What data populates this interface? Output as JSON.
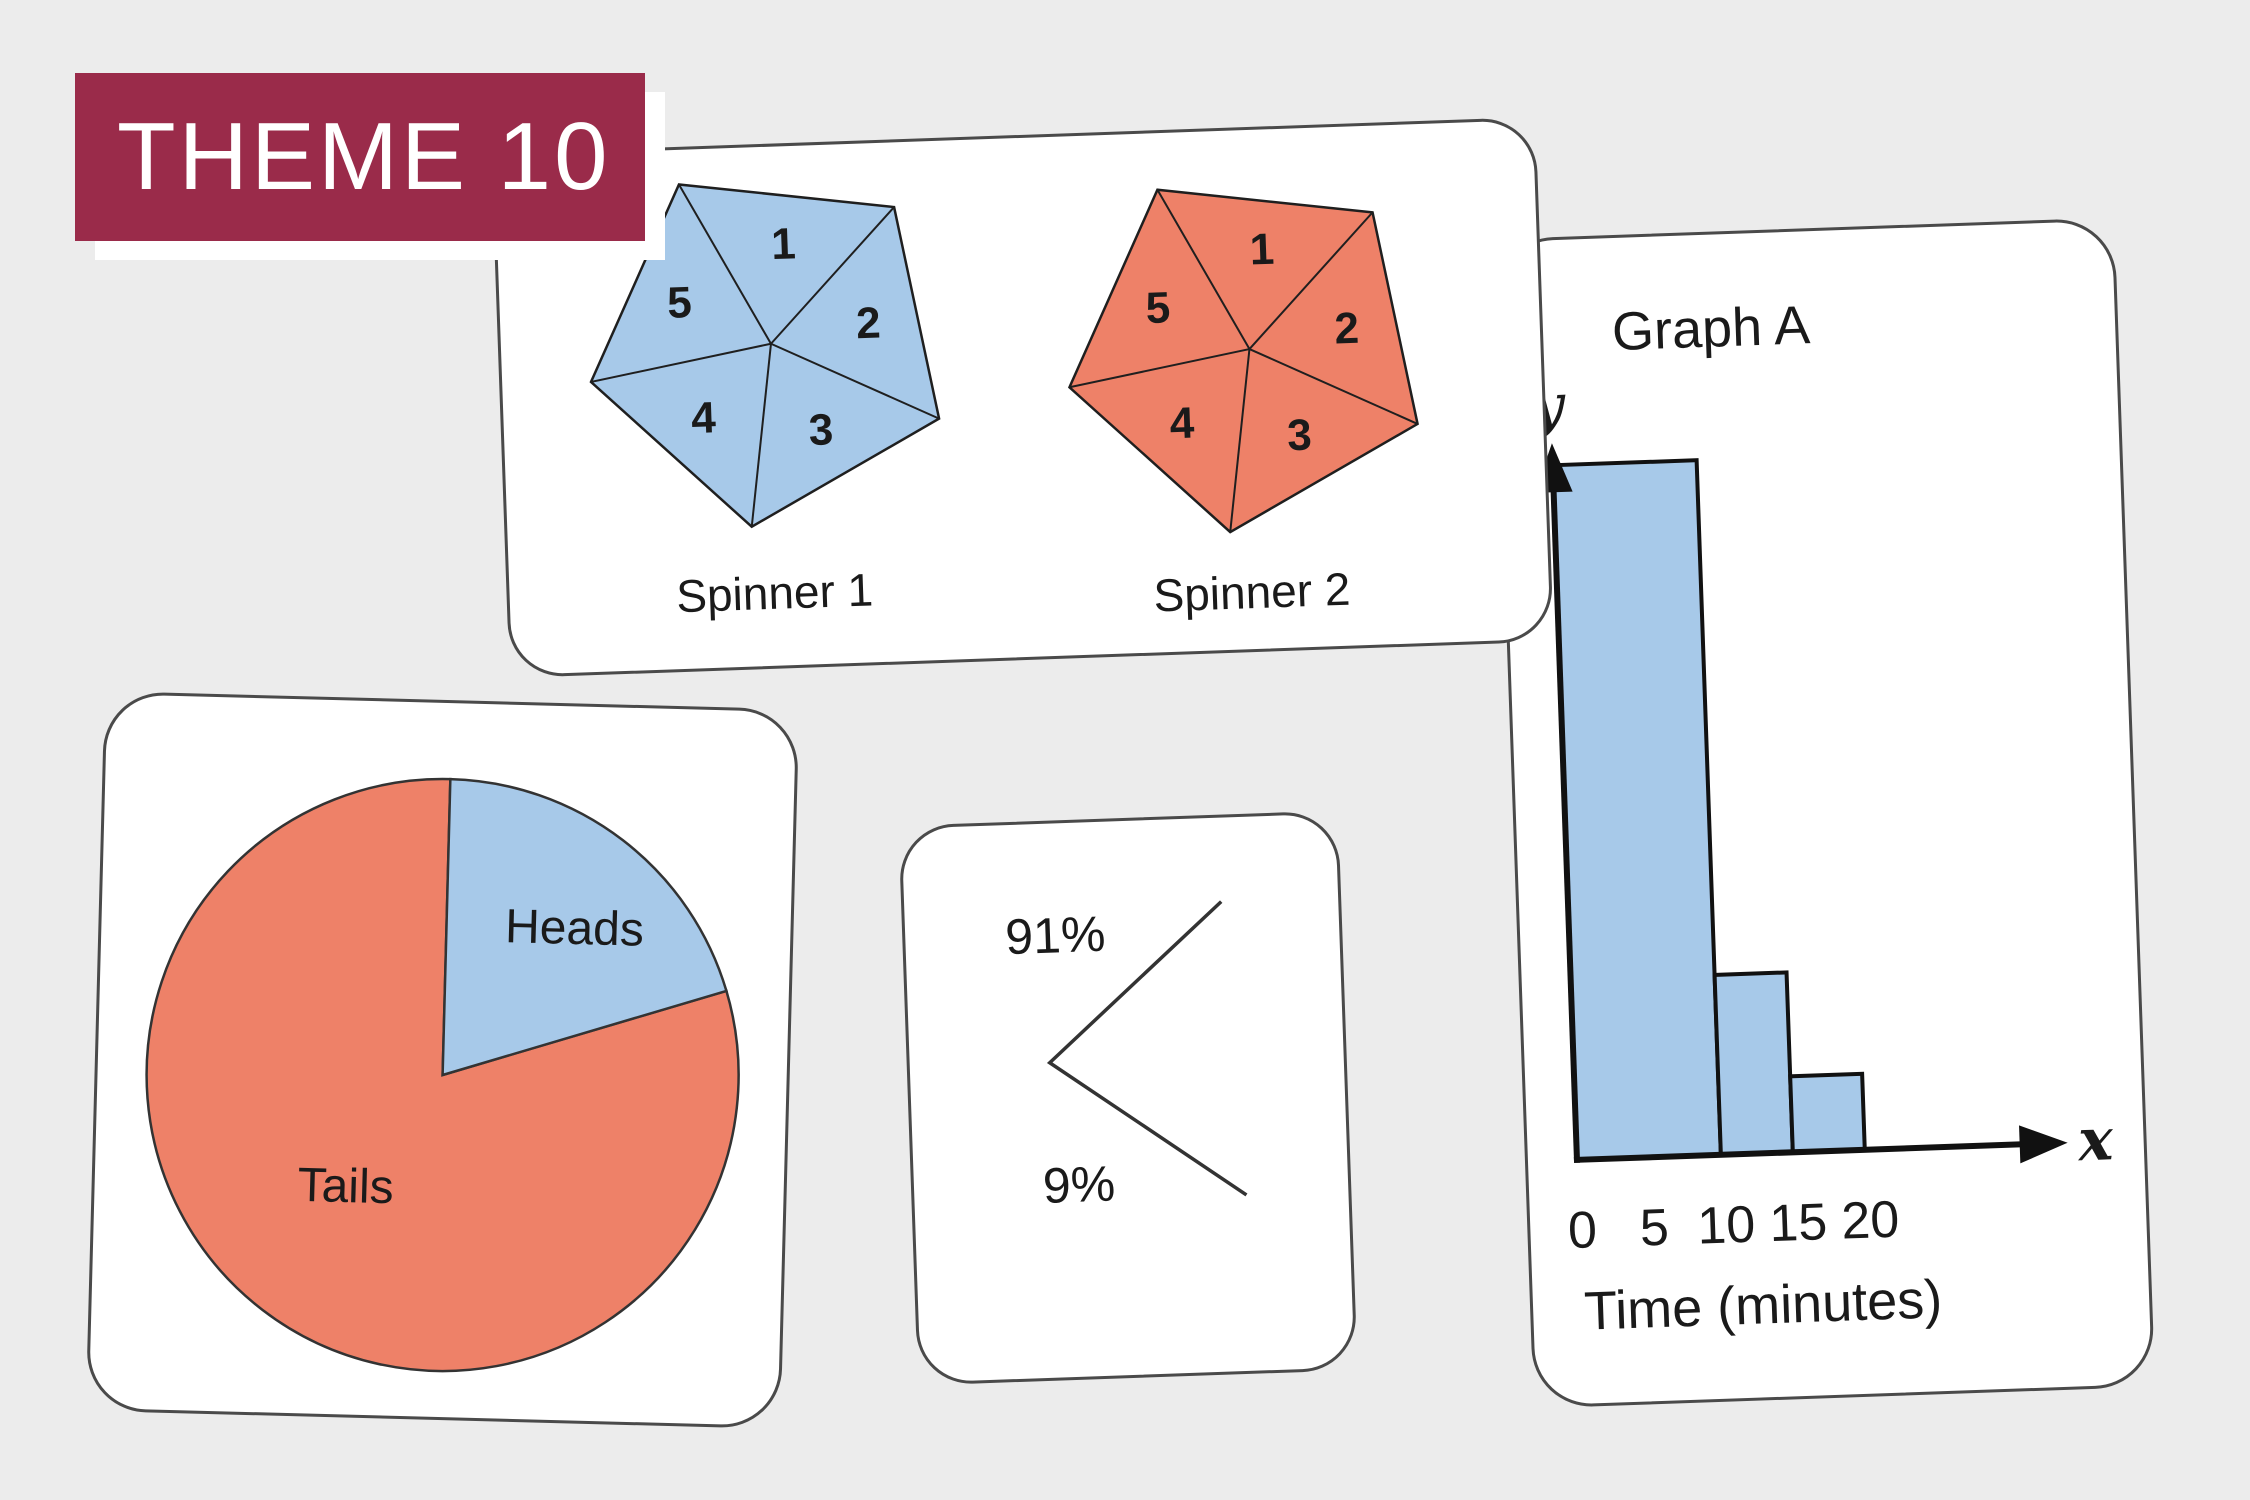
{
  "background_color": "#ececec",
  "banner": {
    "label": "THEME 10",
    "bg_color": "#9a2b4a",
    "text_color": "#ffffff"
  },
  "spinner_card": {
    "spinner1": {
      "label": "Spinner 1",
      "fill_color": "#a7c9e9",
      "sector_numbers": [
        "1",
        "2",
        "3",
        "4",
        "5"
      ]
    },
    "spinner2": {
      "label": "Spinner 2",
      "fill_color": "#ee8168",
      "sector_numbers": [
        "1",
        "2",
        "3",
        "4",
        "5"
      ]
    }
  },
  "graph_card": {
    "title": "Graph A",
    "y_axis_label": "y",
    "x_axis_label": "x",
    "x_ticks": [
      "0",
      "5",
      "10",
      "15",
      "20"
    ],
    "x_axis_title": "Time (minutes)",
    "bar_color": "#a7c9e9"
  },
  "pie_card": {
    "slices": [
      {
        "label": "Heads",
        "percent": 20,
        "color": "#a7c9e9"
      },
      {
        "label": "Tails",
        "percent": 80,
        "color": "#ee8168"
      }
    ]
  },
  "percent_card": {
    "upper_label": "91%",
    "lower_label": "9%"
  },
  "chart_data": [
    {
      "type": "bar",
      "title": "Graph A",
      "xlabel": "Time (minutes)",
      "ylabel": "y",
      "bins": [
        [
          0,
          10
        ],
        [
          10,
          15
        ],
        [
          15,
          20
        ]
      ],
      "relative_heights": [
        9.1,
        2.4,
        1.0
      ],
      "x_ticks": [
        0,
        5,
        10,
        15,
        20
      ],
      "bar_color": "#a7c9e9",
      "note": "histogram-style bars; no y-axis scale shown, heights are relative"
    },
    {
      "type": "pie",
      "categories": [
        "Heads",
        "Tails"
      ],
      "values": [
        20,
        80
      ],
      "colors": [
        "#a7c9e9",
        "#ee8168"
      ],
      "note": "percent estimated from slice angles; Heads starts at 12 o'clock sweeping clockwise"
    },
    {
      "type": "pie",
      "title": "Spinner 1",
      "categories": [
        "1",
        "2",
        "3",
        "4",
        "5"
      ],
      "values": [
        20,
        20,
        20,
        20,
        20
      ],
      "note": "pentagonal spinner, five equal sectors, blue"
    },
    {
      "type": "pie",
      "title": "Spinner 2",
      "categories": [
        "1",
        "2",
        "3",
        "4",
        "5"
      ],
      "values": [
        20,
        20,
        20,
        20,
        20
      ],
      "note": "pentagonal spinner, five equal sectors, orange"
    }
  ]
}
